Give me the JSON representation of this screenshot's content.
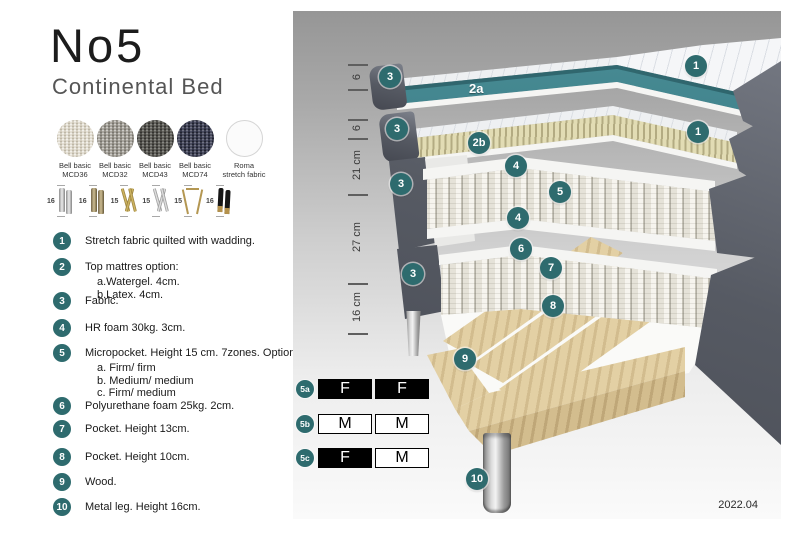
{
  "header": {
    "title": "No5",
    "subtitle": "Continental Bed"
  },
  "swatches": [
    {
      "name": "Bell basic",
      "code": "MCD36",
      "color": "#dfd9cb"
    },
    {
      "name": "Bell basic",
      "code": "MCD32",
      "color": "#9b978e"
    },
    {
      "name": "Bell basic",
      "code": "MCD43",
      "color": "#55544e"
    },
    {
      "name": "Bell basic",
      "code": "MCD74",
      "color": "#3b3e54"
    },
    {
      "name": "Roma",
      "code": "stretch fabric",
      "color": "#fbfbfb"
    }
  ],
  "legs": [
    {
      "height": "16",
      "style": "cylinder-silver"
    },
    {
      "height": "16",
      "style": "cylinder-bronze"
    },
    {
      "height": "15",
      "style": "twisted-gold"
    },
    {
      "height": "15",
      "style": "twisted-silver"
    },
    {
      "height": "15",
      "style": "hairpin-gold"
    },
    {
      "height": "16",
      "style": "tapered-black-gold"
    }
  ],
  "features": [
    {
      "num": "1",
      "text": "Stretch fabric quilted with wadding.",
      "subs": []
    },
    {
      "num": "2",
      "text": "Top mattres option:",
      "subs": [
        "a.Watergel. 4cm.",
        "b.Latex. 4cm."
      ]
    },
    {
      "num": "3",
      "text": "Fabric.",
      "subs": []
    },
    {
      "num": "4",
      "text": "HR foam 30kg. 3cm.",
      "subs": []
    },
    {
      "num": "5",
      "text": "Micropocket. Height 15 cm. 7zones. Option:",
      "subs": [
        "a. Firm/ firm",
        "b. Medium/ medium",
        "c. Firm/ medium"
      ]
    },
    {
      "num": "6",
      "text": "Polyurethane foam 25kg. 2cm.",
      "subs": []
    },
    {
      "num": "7",
      "text": "Pocket. Height 13cm.",
      "subs": []
    },
    {
      "num": "8",
      "text": "Pocket. Height 10cm.",
      "subs": []
    },
    {
      "num": "9",
      "text": "Wood.",
      "subs": []
    },
    {
      "num": "10",
      "text": "Metal leg. Height 16cm.",
      "subs": []
    }
  ],
  "diagram": {
    "ruler": {
      "seg1": "6",
      "seg2": "6",
      "seg3": "21 cm",
      "seg4": "27 cm",
      "seg5": "16 cm"
    },
    "callouts": {
      "c1a": "1",
      "c3a": "3",
      "l2a": "2a",
      "c1b": "1",
      "c3b": "3",
      "c2b": "2b",
      "c4a": "4",
      "c3c": "3",
      "c5": "5",
      "c4b": "4",
      "c6": "6",
      "c7": "7",
      "c3d": "3",
      "c8": "8",
      "c9": "9",
      "c10": "10"
    },
    "firmness": [
      {
        "label": "5a",
        "cell1": "F",
        "cell2": "F"
      },
      {
        "label": "5b",
        "cell1": "M",
        "cell2": "M"
      },
      {
        "label": "5c",
        "cell1": "F",
        "cell2": "M"
      }
    ],
    "version": "2022.04"
  },
  "colors": {
    "accent_teal": "#2e6b6e",
    "watergel_teal": "#3a7d85",
    "fabric_dark_gray": "#565a63",
    "latex_beige": "#e2dcb4",
    "wood_tan": "#e3d0a4"
  }
}
